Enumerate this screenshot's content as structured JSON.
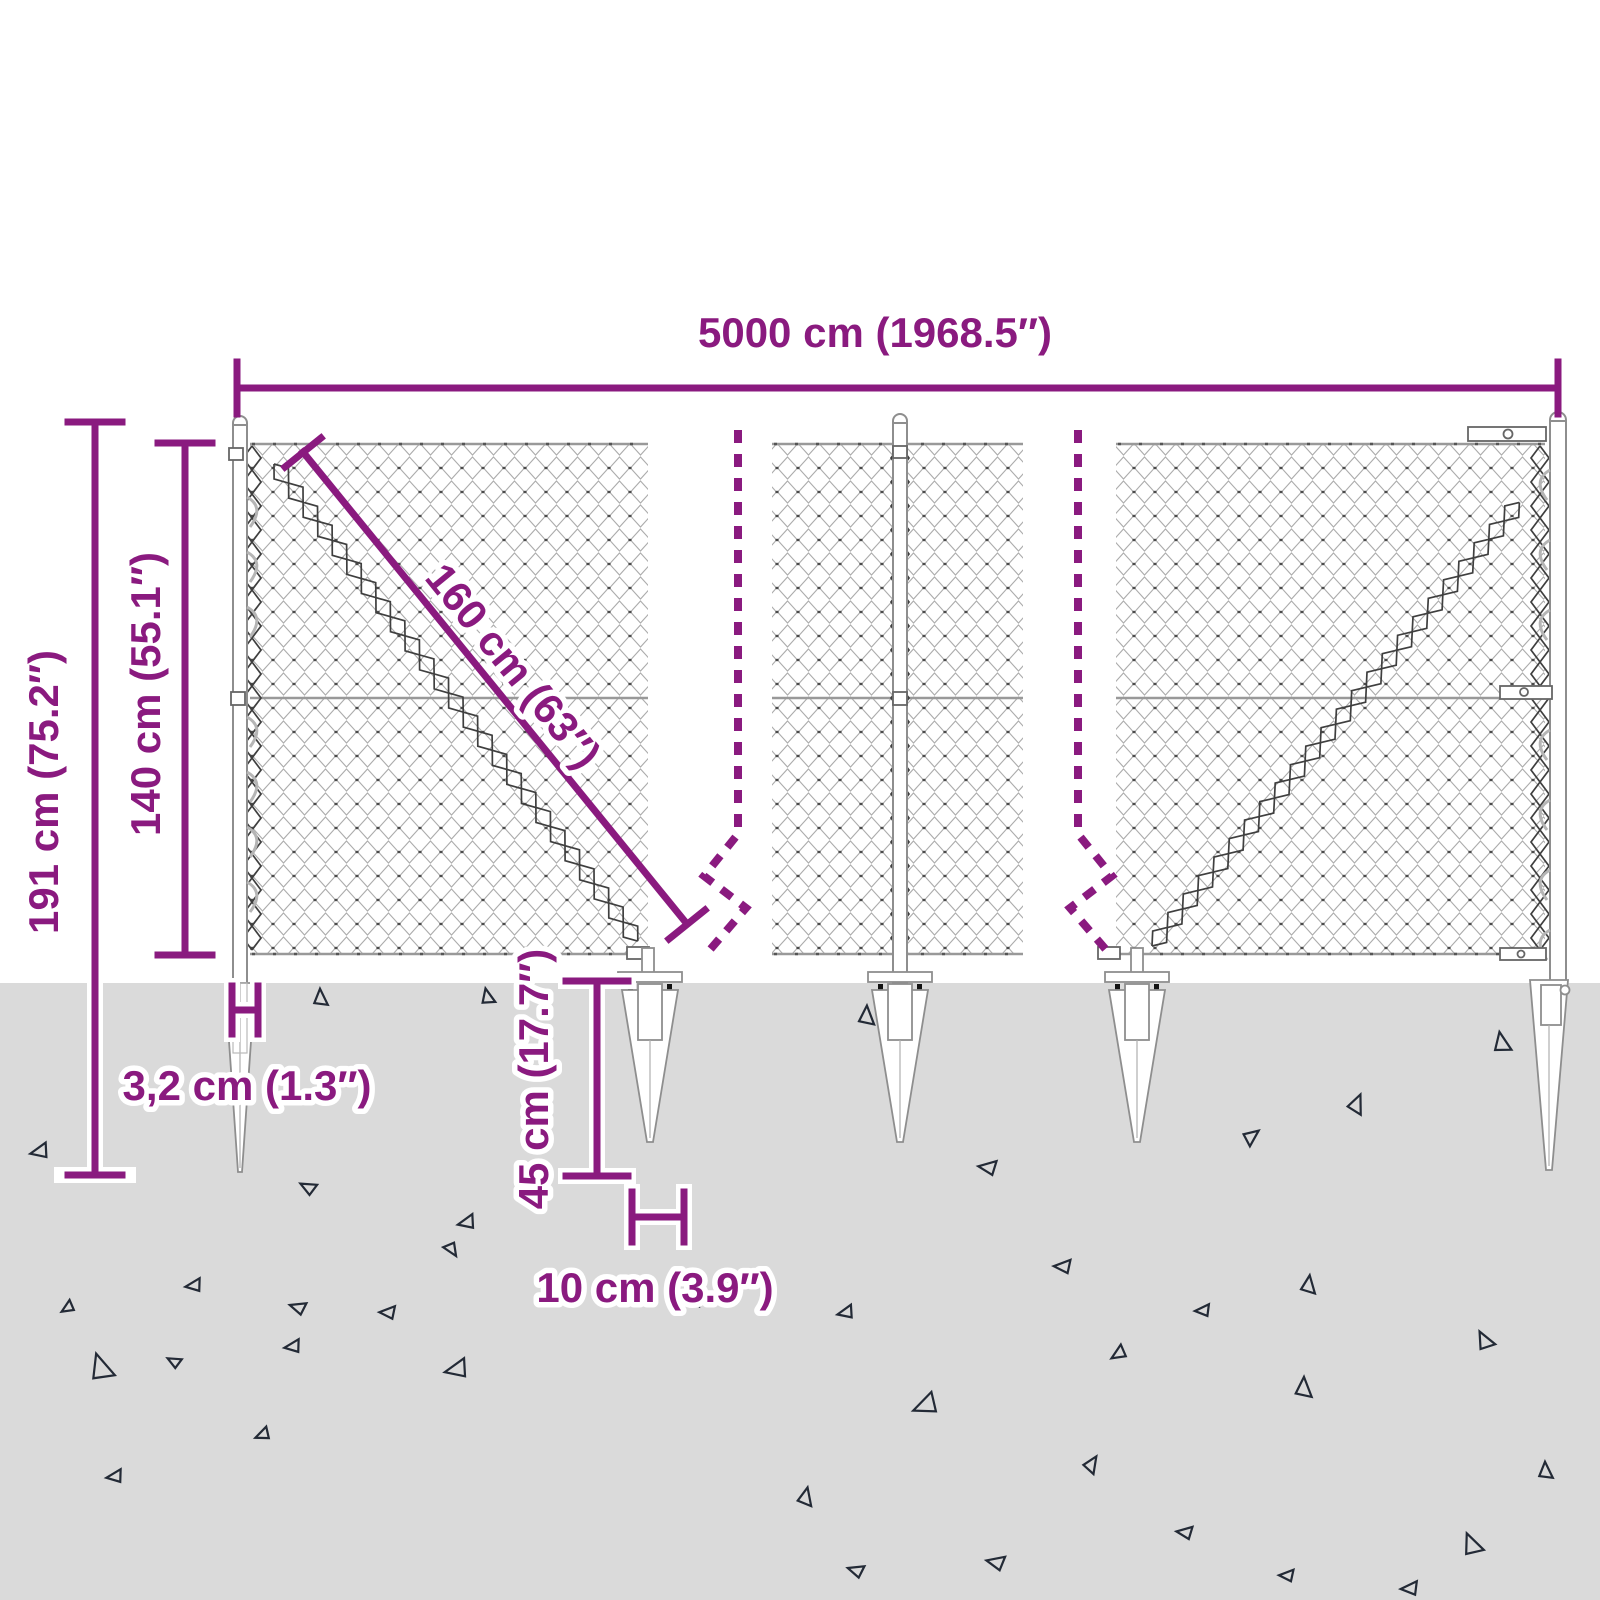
{
  "diagram": {
    "name": "Chain-link fence with spike ground anchors — dimension drawing",
    "dimensions": {
      "total_width": "5000 cm (1968.5″)",
      "overall_height": "191 cm (75.2″)",
      "fence_height": "140 cm (55.1″)",
      "mesh_diagonal": "160 cm (63″)",
      "post_width": "3,2 cm (1.3″)",
      "anchor_depth": "45 cm (17.7″)",
      "anchor_spike_width": "10 cm (3.9″)"
    },
    "colors": {
      "accent": "#8A1A7F",
      "ground": "#DADADA",
      "mesh_wire": "#ACACAC",
      "dark_wire": "#3F3F3F",
      "debris_triangle": "#232A36"
    }
  }
}
